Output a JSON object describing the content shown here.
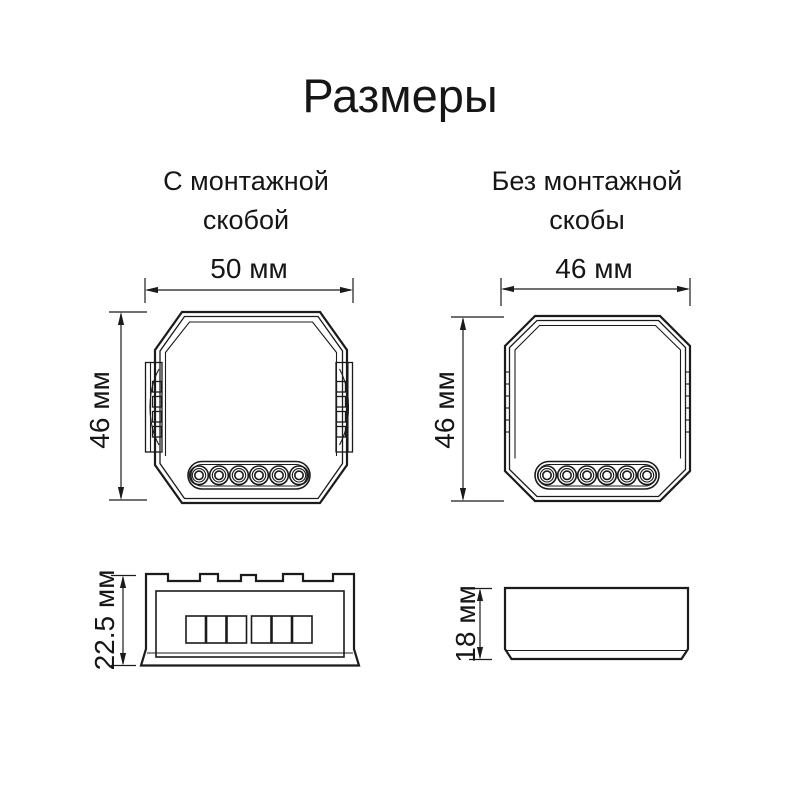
{
  "title": "Размеры",
  "line_color": "#1b1b1b",
  "views": {
    "with_bracket": {
      "caption": [
        "С монтажной",
        "скобой"
      ],
      "width": "50 мм",
      "height": "46 мм",
      "depth": "22.5 мм"
    },
    "without_bracket": {
      "caption": [
        "Без монтажной",
        "скобы"
      ],
      "width": "46 мм",
      "height": "46 мм",
      "depth": "18 мм"
    }
  }
}
